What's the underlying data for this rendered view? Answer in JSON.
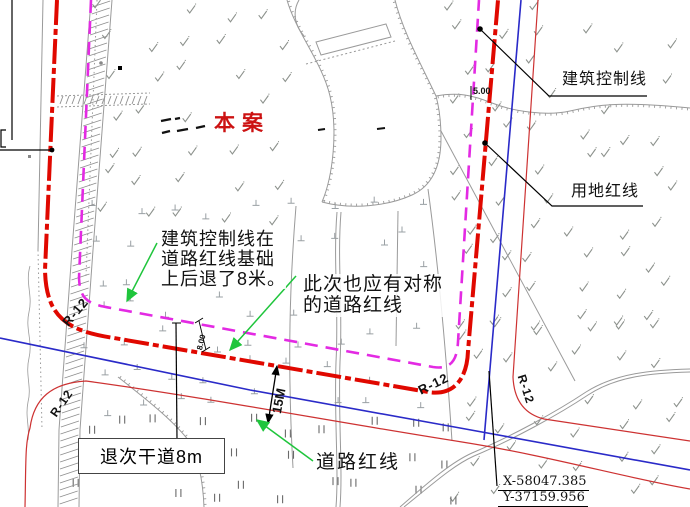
{
  "labels": {
    "case_marker": "本案",
    "building_control_line": "建筑控制线",
    "land_use_red_line": "用地红线",
    "road_red_line": "道路红线",
    "setback_note": {
      "line1": "建筑控制线在",
      "line2": "道路红线基础",
      "line3": "上后退了8米。"
    },
    "symmetry_note": {
      "line1": "此次也应有对称",
      "line2": "的道路红线"
    },
    "setback_box": "退次干道8m",
    "coords": {
      "x": "X-58047.385",
      "y": "Y-37159.956"
    },
    "dims": {
      "top_offset": "5.00",
      "side_offset": "8.00",
      "road_width": "15M"
    },
    "radius_label": "R-12"
  },
  "colors": {
    "boundary_red": "#e00800",
    "control_magenta": "#e32ae3",
    "road_blue": "#2a2ac8",
    "road_red_thin": "#cd3232",
    "annotation_green": "#1fc53c",
    "contour_gray": "#9a9a9a",
    "case_red": "#cc1212"
  }
}
